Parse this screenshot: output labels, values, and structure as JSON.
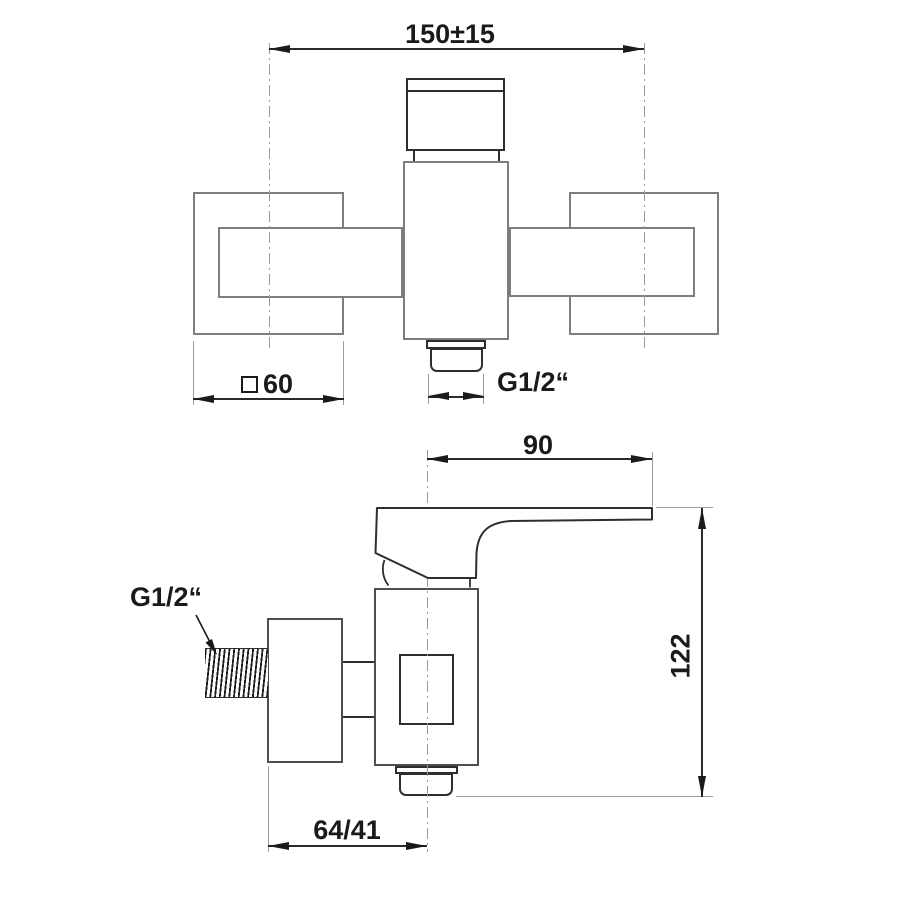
{
  "drawing_type": "faucet technical dimension drawing",
  "front_view": {
    "dims": {
      "center_distance": "150±15",
      "plate_size_symbol": "□",
      "plate_size": "60",
      "outlet_thread": "G1/2“"
    }
  },
  "side_view": {
    "dims": {
      "lever_reach": "90",
      "total_height": "122",
      "wall_offset": "64/41",
      "inlet_thread": "G1/2“"
    }
  },
  "colors": {
    "background": "#ffffff",
    "outline_gray": "#7e7e7e",
    "outline_dark": "#2e2e2e",
    "dimension": "#1a1a1a"
  }
}
